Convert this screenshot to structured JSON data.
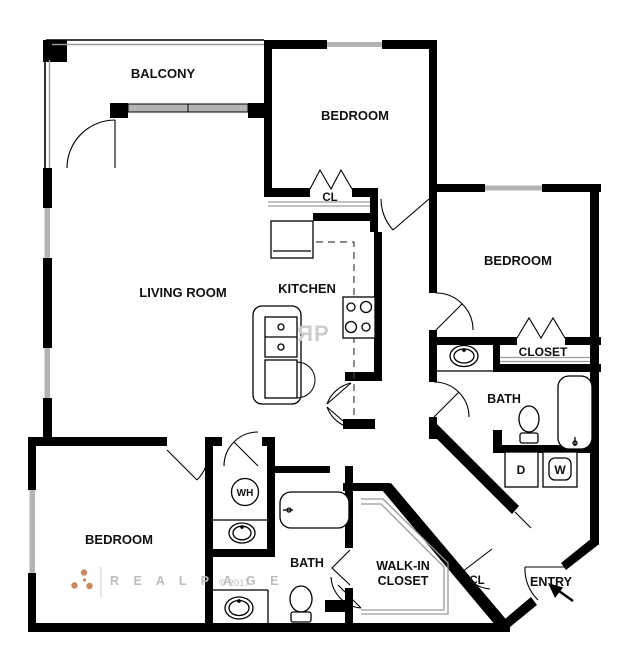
{
  "floorplan": {
    "labels": {
      "balcony": "BALCONY",
      "bedroom_top": "BEDROOM",
      "bedroom_right": "BEDROOM",
      "bedroom_bottom": "BEDROOM",
      "living_room": "LIVING ROOM",
      "kitchen": "KITCHEN",
      "closet_top": "CL",
      "closet_right": "CLOSET",
      "bath_right": "BATH",
      "bath_bottom": "BATH",
      "walk_in_line1": "WALK-IN",
      "walk_in_line2": "CLOSET",
      "closet_hall": "CL",
      "entry": "ENTRY",
      "water_heater": "WH",
      "dryer": "D",
      "washer": "W"
    },
    "watermark": {
      "brand_spaced": "R E A L P A G E",
      "copyright": "© 2017",
      "monogram_r": "R",
      "monogram_p": "P"
    },
    "colors": {
      "wall": "#000000",
      "window_glass": "#b3b3b3",
      "shelf_line": "#9a9a9a",
      "watermark_text": "#bdbdbd",
      "logo_dots": "#c9885f",
      "monogram_gray": "#cdcdcd",
      "background": "#ffffff"
    }
  }
}
